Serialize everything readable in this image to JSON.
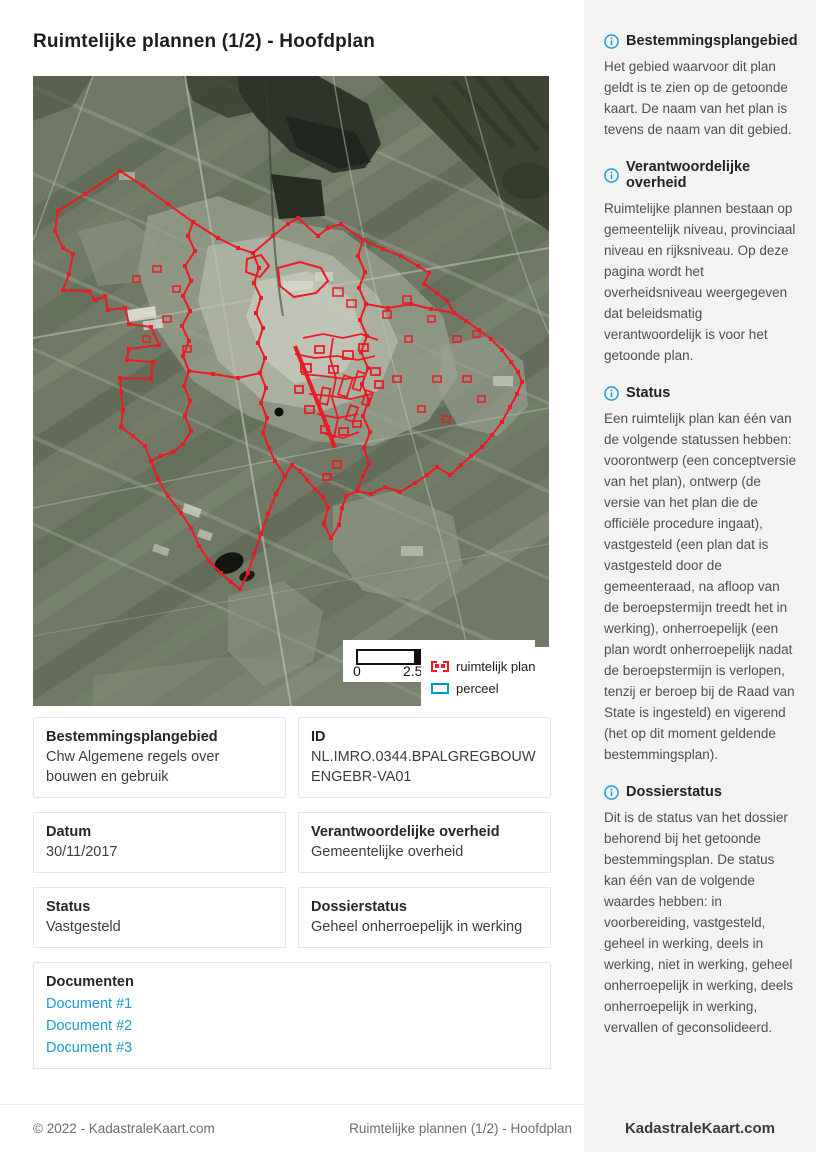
{
  "page": {
    "title": "Ruimtelijke plannen (1/2) - Hoofdplan"
  },
  "map": {
    "scale": {
      "start": "0",
      "mid": "2.5"
    },
    "legend": [
      {
        "label": "ruimtelijk plan",
        "swatch": "red-dashed-rect"
      },
      {
        "label": "perceel",
        "swatch": "cyan-rect"
      }
    ],
    "colors": {
      "plan_outline": "#ea1b22",
      "parcel_outline": "#0098c4"
    }
  },
  "cards": [
    {
      "label": "Bestemmingsplangebied",
      "value": "Chw Algemene regels over bouwen en gebruik"
    },
    {
      "label": "ID",
      "value": "NL.IMRO.0344.BPALGREGBOUWENGEBR-VA01"
    },
    {
      "label": "Datum",
      "value": "30/11/2017"
    },
    {
      "label": "Verantwoordelijke overheid",
      "value": "Gemeentelijke overheid"
    },
    {
      "label": "Status",
      "value": "Vastgesteld"
    },
    {
      "label": "Dossierstatus",
      "value": "Geheel onherroepelijk in werking"
    }
  ],
  "documents": {
    "label": "Documenten",
    "links": [
      "Document #1",
      "Document #2",
      "Document #3"
    ]
  },
  "sidebar": {
    "sections": [
      {
        "heading": "Bestemmingsplangebied",
        "body": "Het gebied waarvoor dit plan geldt is te zien op de getoonde kaart. De naam van het plan is tevens de naam van dit gebied."
      },
      {
        "heading": "Verantwoordelijke overheid",
        "body": "Ruimtelijke plannen bestaan op gemeentelijk niveau, provinciaal niveau en rijksniveau. Op deze pagina wordt het overheidsniveau weergegeven dat beleidsmatig verantwoordelijk is voor het getoonde plan."
      },
      {
        "heading": "Status",
        "body": "Een ruimtelijk plan kan één van de volgende statussen hebben: voorontwerp (een conceptversie van het plan), ontwerp (de versie van het plan die de officiële procedure ingaat), vastgesteld (een plan dat is vastgesteld door de gemeenteraad, na afloop van de beroepstermijn treedt het in werking), onherroepelijk (een plan wordt onherroepelijk nadat de beroepstermijn is verlopen, tenzij er beroep bij de Raad van State is ingesteld) en vigerend (het op dit moment geldende bestemmingsplan)."
      },
      {
        "heading": "Dossierstatus",
        "body": "Dit is de status van het dossier behorend bij het getoonde bestemmingsplan. De status kan één van de volgende waardes hebben: in voorbereiding, vastgesteld, geheel in werking, deels in werking, niet in werking, geheel onherroepelijk in werking, deels onherroepelijk in werking, vervallen of geconsolideerd."
      }
    ]
  },
  "footer": {
    "copyright": "© 2022 - KadastraleKaart.com",
    "center": "Ruimtelijke plannen (1/2) - Hoofdplan",
    "brand": "KadastraleKaart.com"
  }
}
